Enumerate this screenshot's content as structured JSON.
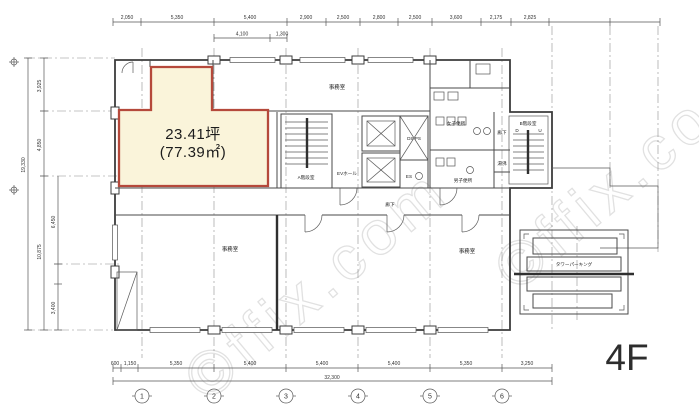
{
  "floor_label": "4F",
  "watermark": "©ffix.com",
  "highlight_room": {
    "area_tsubo": "23.41坪",
    "area_sqm": "(77.39㎡)"
  },
  "rooms": {
    "office_top": "事務室",
    "office_left": "事務室",
    "office_right": "事務室",
    "ev_hall": "EVホール",
    "shaft": "DS PS",
    "es": "ES",
    "stair_a": "A階段室",
    "stair_b": "B階段室",
    "stair_down": "D",
    "stair_up": "U",
    "wc_women": "女子便所",
    "wc_men": "男子便所",
    "hot_water": "湯沸",
    "corridor_right": "廊下",
    "corridor_center": "廊下",
    "tower_parking": "タワーパーキング"
  },
  "dims": {
    "top_row1": [
      "2,050",
      "5,350",
      "5,400",
      "2,900",
      "2,500",
      "2,800",
      "2,500",
      "3,600",
      "2,175",
      "2,825"
    ],
    "top_row2": [
      "4,100",
      "1,300"
    ],
    "left_outer_total": "19,330",
    "left_col": [
      "3,925",
      "4,850",
      "10,875",
      "6,450",
      "3,400"
    ],
    "bottom_row": [
      "600",
      "1,150",
      "5,350",
      "5,400",
      "5,400",
      "5,400",
      "5,350",
      "3,250"
    ],
    "bottom_total": "32,300",
    "grid_bubbles": [
      "1",
      "2",
      "3",
      "4",
      "5",
      "6"
    ]
  },
  "colors": {
    "highlight_fill": "#FAF4DA",
    "highlight_border": "#B5493B",
    "line": "#3C3C3C"
  }
}
